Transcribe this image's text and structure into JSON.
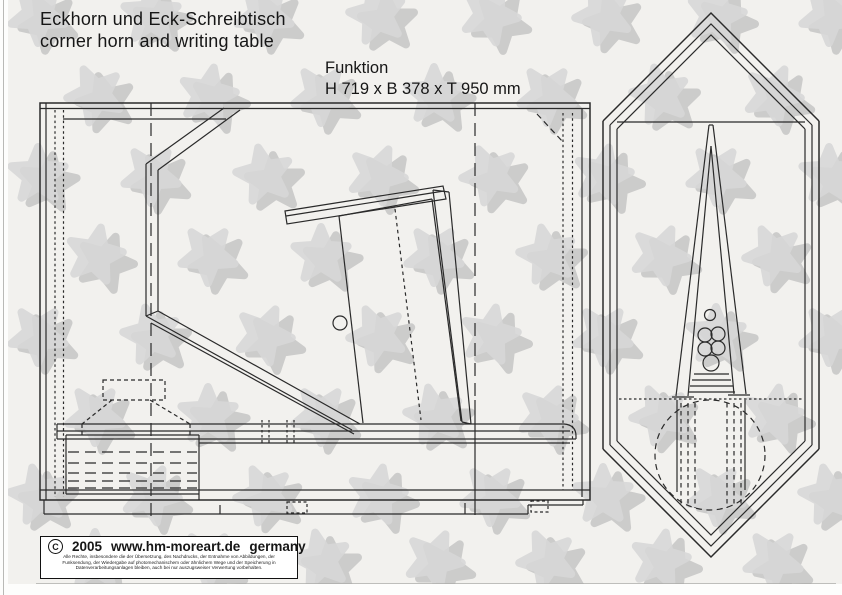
{
  "page": {
    "title_de": "Eckhorn und Eck-Schreibtisch",
    "title_en": "corner horn and writing table",
    "spec": {
      "label": "Funktion",
      "dimensions": "H 719 x B 378 x T 950 mm"
    }
  },
  "footer": {
    "copyright_symbol": "c",
    "year": "2005",
    "website": "www.hm-moreart.de",
    "country": "germany",
    "legal_lines": [
      "Alle Rechte, insbesondere die der Übersetzung, des Nachdrucks, der Entnahme von Abbildungen, der",
      "Funksendung, der Wiedergabe auf photomechanischem oder ähnlichem Wege und der Speicherung in",
      "Datenverarbeitungsanlagen bleiben, auch bei nur auszugsweiser Verwertung vorbehalten."
    ]
  },
  "colors": {
    "page_bg": "#f2f1ee",
    "line": "#2a2a2a",
    "watermark_dark": "#b9b9b9",
    "watermark_light": "#d8d8d8"
  }
}
